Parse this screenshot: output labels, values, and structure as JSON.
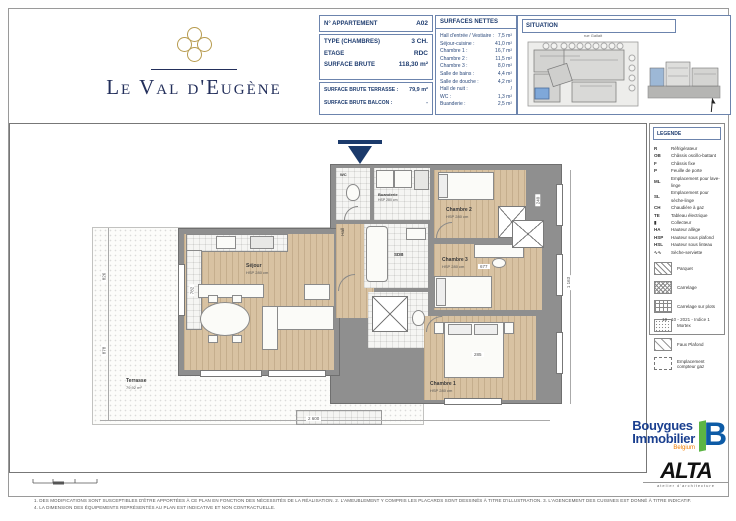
{
  "logo": {
    "title": "Le Val d'Eugène"
  },
  "apartment": {
    "header_label": "N° APPARTEMENT",
    "header_value": "A02",
    "rows": [
      {
        "label": "TYPE (CHAMBRES)",
        "value": "3 CH."
      },
      {
        "label": "ETAGE",
        "value": "RDC"
      },
      {
        "label": "SURFACE BRUTE",
        "value": "118,30 m²"
      }
    ],
    "rows2": [
      {
        "label": "SURFACE BRUTE TERRASSE :",
        "value": "79,9 m²"
      },
      {
        "label": "SURFACE BRUTE BALCON :",
        "value": "-"
      }
    ]
  },
  "surfaces": {
    "title": "SURFACES NETTES",
    "rows": [
      {
        "label": "Hall d'entrée / Vestiaire :",
        "value": "7,5 m²"
      },
      {
        "label": "Séjour-cuisine :",
        "value": "41,0 m²"
      },
      {
        "label": "Chambre 1 :",
        "value": "16,7 m²"
      },
      {
        "label": "Chambre 2 :",
        "value": "11,5 m²"
      },
      {
        "label": "Chambre 3 :",
        "value": "8,0 m²"
      },
      {
        "label": "Salle de bains :",
        "value": "4,4 m²"
      },
      {
        "label": "Salle de douche :",
        "value": "4,2 m²"
      },
      {
        "label": "Hall de nuit :",
        "value": "/"
      },
      {
        "label": "WC :",
        "value": "1,3 m²"
      },
      {
        "label": "Buanderie :",
        "value": "2,5 m²"
      }
    ]
  },
  "situation": {
    "title": "SITUATION",
    "street": "rue Gallait"
  },
  "legend": {
    "title": "LEGENDE",
    "items": [
      {
        "sym": "R",
        "label": "Réfrigérateur"
      },
      {
        "sym": "OB",
        "label": "Châssis oscillo-battant"
      },
      {
        "sym": "F",
        "label": "Châssis fixe"
      },
      {
        "sym": "P",
        "label": "Feuille de porte"
      },
      {
        "sym": "ML",
        "label": "Emplacement pour lave-linge"
      },
      {
        "sym": "SL",
        "label": "Emplacement pour sèche-linge"
      },
      {
        "sym": "CH",
        "label": "Chaudière à gaz"
      },
      {
        "sym": "TE",
        "label": "Tableau électrique"
      },
      {
        "sym": "▮",
        "label": "Collecteur"
      },
      {
        "sym": "HA",
        "label": "Hauteur allège"
      },
      {
        "sym": "HSP",
        "label": "Hauteur sous plafond"
      },
      {
        "sym": "HSL",
        "label": "Hauteur sous linteau"
      },
      {
        "sym": "∿∿",
        "label": "Sèche-serviette"
      }
    ],
    "patterns": [
      {
        "label": "Parquet"
      },
      {
        "label": "Carrelage"
      },
      {
        "label": "Carrelage sur plots"
      },
      {
        "label": "Mortex"
      },
      {
        "label": "Faux Plafond"
      },
      {
        "label": "Emplacement compteur gaz"
      }
    ],
    "date": "19 - 10 - 2021   -   Indice 1"
  },
  "plan": {
    "rooms": {
      "sejour": "Séjour",
      "sejour_sub": "HSP 280 cm",
      "hall": "Hall",
      "wc": "WC",
      "buanderie": "Buanderie",
      "buanderie_sub": "HSP 280 cm",
      "sdb": "SDB",
      "chambre1": "Chambre 1",
      "chambre1_sub": "HSP 280 cm",
      "chambre2": "Chambre 2",
      "chambre2_sub": "HSP 280 cm",
      "chambre3": "Chambre 3",
      "chambre3_sub": "HSP 280 cm",
      "terrasse": "Terrasse",
      "terrasse_sub": "79,92 m²"
    },
    "dims": [
      "2 600",
      "826",
      "878",
      "1 163",
      "782",
      "677",
      "285",
      "240"
    ]
  },
  "footer": {
    "line1": "1. DES MODIFICATIONS SONT SUSCEPTIBLES D'ÊTRE APPORTÉES À CE PLAN EN FONCTION DES NÉCESSITÉS DE LA RÉALISATION.   2. L'AMEUBLEMENT Y COMPRIS LES PLACARDS SONT DESSINÉS À TITRE D'ILLUSTRATION.   3. L'AGENCEMENT DES CUISINES EST DONNÉ À TITRE INDICATIF.",
    "line2": "4. LA DIMENSION DES ÉQUIPEMENTS REPRÉSENTÉS AU PLAN EST INDICATIVE ET NON CONTRACTUELLE."
  },
  "brands": {
    "bouygues_1": "Bouygues",
    "bouygues_2": "Immobilier",
    "bouygues_sub": "Belgium",
    "bouygues_mark": "B",
    "alta": "ALTA",
    "alta_sub": "atelier d'architecture"
  }
}
